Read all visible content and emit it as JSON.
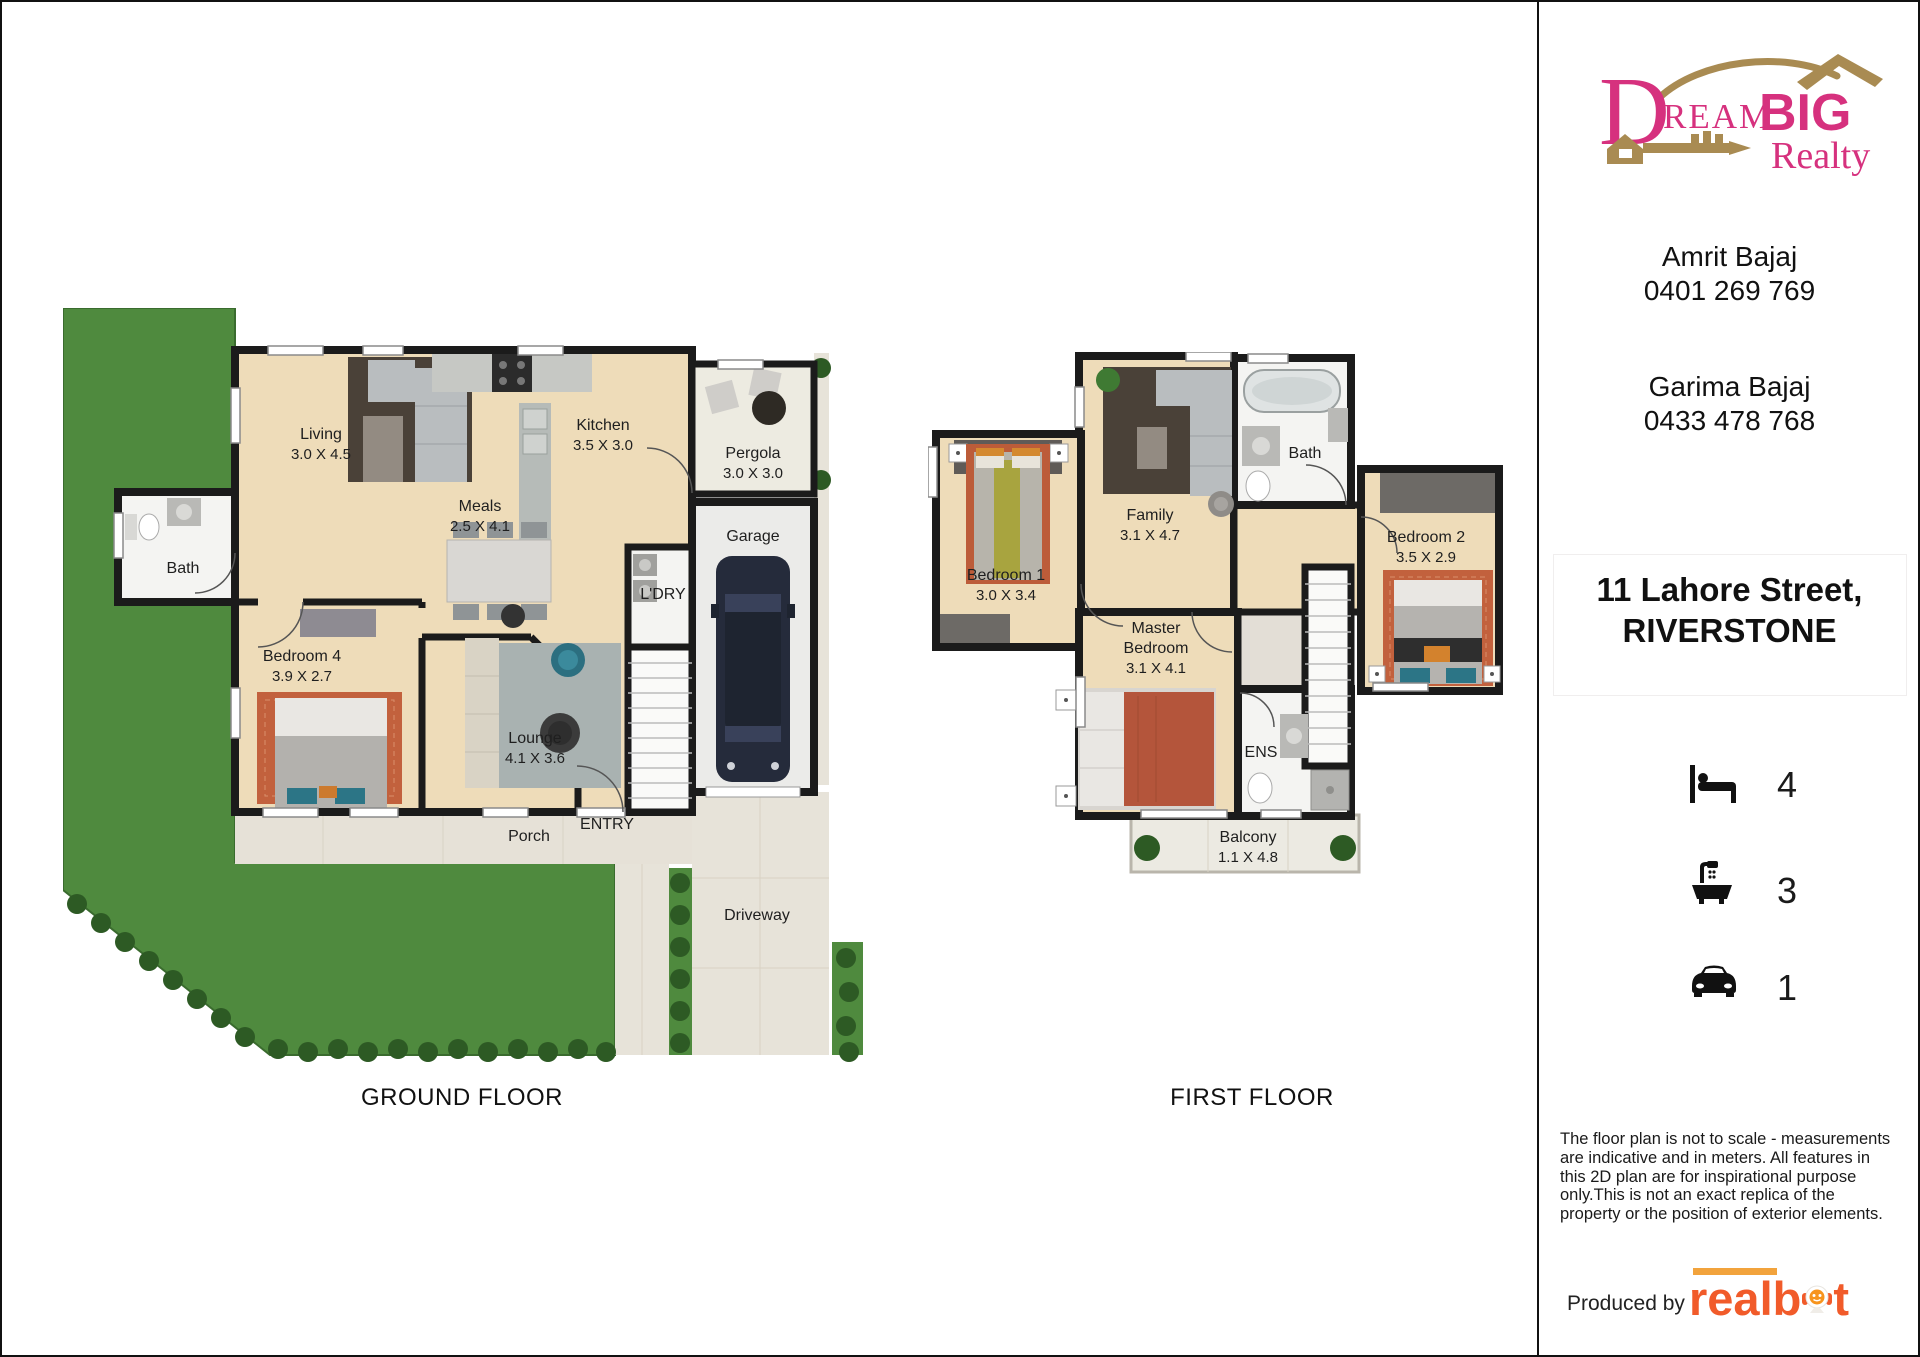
{
  "brand": {
    "dream": "Dream",
    "big": "BIG",
    "realty": "Realty",
    "pink": "#d6317e",
    "gold": "#a98b52"
  },
  "agents": [
    {
      "name": "Amrit Bajaj",
      "phone": "0401 269 769"
    },
    {
      "name": "Garima Bajaj",
      "phone": "0433 478 768"
    }
  ],
  "address": {
    "line1": "11 Lahore Street,",
    "line2": "RIVERSTONE"
  },
  "features": [
    {
      "icon": "bed-icon",
      "count": "4"
    },
    {
      "icon": "bath-icon",
      "count": "3"
    },
    {
      "icon": "car-icon",
      "count": "1"
    }
  ],
  "disclaimer": "The floor plan is not to scale - measurements are indicative and in meters. All features in this 2D plan are for inspirational purpose only.This is not an exact replica of the property or the position of exterior elements.",
  "credit": {
    "produced_by": "Produced by",
    "brand_left": "real",
    "brand_mid": "b",
    "brand_right": "t"
  },
  "colors": {
    "lawn": "#4f8a3e",
    "bush": "#2d5a24",
    "wall": "#1b1b1b",
    "wood": "#eedcb9",
    "tile": "#f4f4f2",
    "concrete": "#e7e3d9",
    "accent_orange": "#f15b2a"
  },
  "ground_floor": {
    "title": "GROUND FLOOR",
    "rooms": {
      "living": {
        "name": "Living",
        "dims": "3.0 X 4.5"
      },
      "kitchen": {
        "name": "Kitchen",
        "dims": "3.5 X 3.0"
      },
      "pergola": {
        "name": "Pergola",
        "dims": "3.0 X 3.0"
      },
      "meals": {
        "name": "Meals",
        "dims": "2.5 X 4.1"
      },
      "bath": {
        "name": "Bath"
      },
      "garage": {
        "name": "Garage"
      },
      "laundry": {
        "name": "L'DRY"
      },
      "bedroom4": {
        "name": "Bedroom 4",
        "dims": "3.9 X 2.7"
      },
      "lounge": {
        "name": "Lounge",
        "dims": "4.1 X 3.6"
      },
      "porch": {
        "name": "Porch"
      },
      "entry": {
        "name": "ENTRY"
      },
      "driveway": {
        "name": "Driveway"
      }
    }
  },
  "first_floor": {
    "title": "FIRST FLOOR",
    "rooms": {
      "bedroom1": {
        "name": "Bedroom 1",
        "dims": "3.0 X 3.4"
      },
      "family": {
        "name": "Family",
        "dims": "3.1 X 4.7"
      },
      "bath": {
        "name": "Bath"
      },
      "bedroom2": {
        "name": "Bedroom 2",
        "dims": "3.5 X 2.9"
      },
      "master": {
        "name_line1": "Master",
        "name_line2": "Bedroom",
        "dims": "3.1 X 4.1"
      },
      "ens": {
        "name": "ENS"
      },
      "balcony": {
        "name": "Balcony",
        "dims": "1.1 X 4.8"
      }
    }
  }
}
